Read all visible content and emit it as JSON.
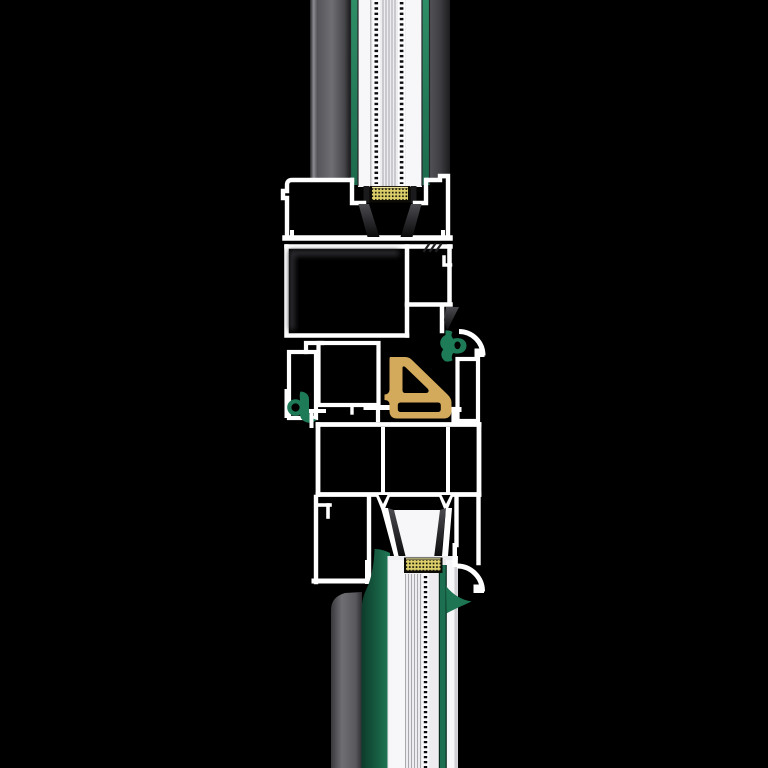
{
  "meta": {
    "title": "Window profile vertical cross-section render",
    "type": "technical-cross-section",
    "visible_text": []
  },
  "canvas": {
    "width": 768,
    "height": 768
  },
  "palette": {
    "background": "#000000",
    "outline-white": "#ffffff",
    "glass-base": "#ededef",
    "glass-bright": "#f7f7f9",
    "glass-channel": "#fbfbfd",
    "glass-edge": "#cfcfd4",
    "glass-line": "#a8a8ae",
    "glass-line-strong": "#26262a",
    "gasket-green": "#1e7b57",
    "green-dark": "#0d3b2a",
    "green-mid": "#1c6f50",
    "green-bright": "#2e8e66",
    "seal-gold": "#d3aa5b",
    "spacer-gold": "#ddd06a",
    "spacer-dot": "#14130a",
    "spacer-border": "#0c0b06",
    "gray-light": "#6e6e73",
    "gray-mid": "#55555a",
    "gray-dark": "#2c2c2e",
    "wedge-top": "#4b4b50",
    "wedge-bottom": "#0a0a0b",
    "hatch": "#202023"
  },
  "components": [
    {
      "id": "upper-glazing-unit",
      "kind": "triple-glazing"
    },
    {
      "id": "upper-spacer-bar",
      "kind": "warm-edge-spacer"
    },
    {
      "id": "sash-bottom-rail-profile",
      "kind": "profile-outline"
    },
    {
      "id": "right-inner-gasket",
      "kind": "gasket-green"
    },
    {
      "id": "left-outer-gasket",
      "kind": "gasket-green"
    },
    {
      "id": "center-seal",
      "kind": "gasket-gold"
    },
    {
      "id": "frame-main-chamber",
      "kind": "profile-outline"
    },
    {
      "id": "frame-glazing-rebate",
      "kind": "profile-outline"
    },
    {
      "id": "lower-spacer-bar",
      "kind": "warm-edge-spacer"
    },
    {
      "id": "lower-glazing-unit",
      "kind": "triple-glazing"
    }
  ]
}
